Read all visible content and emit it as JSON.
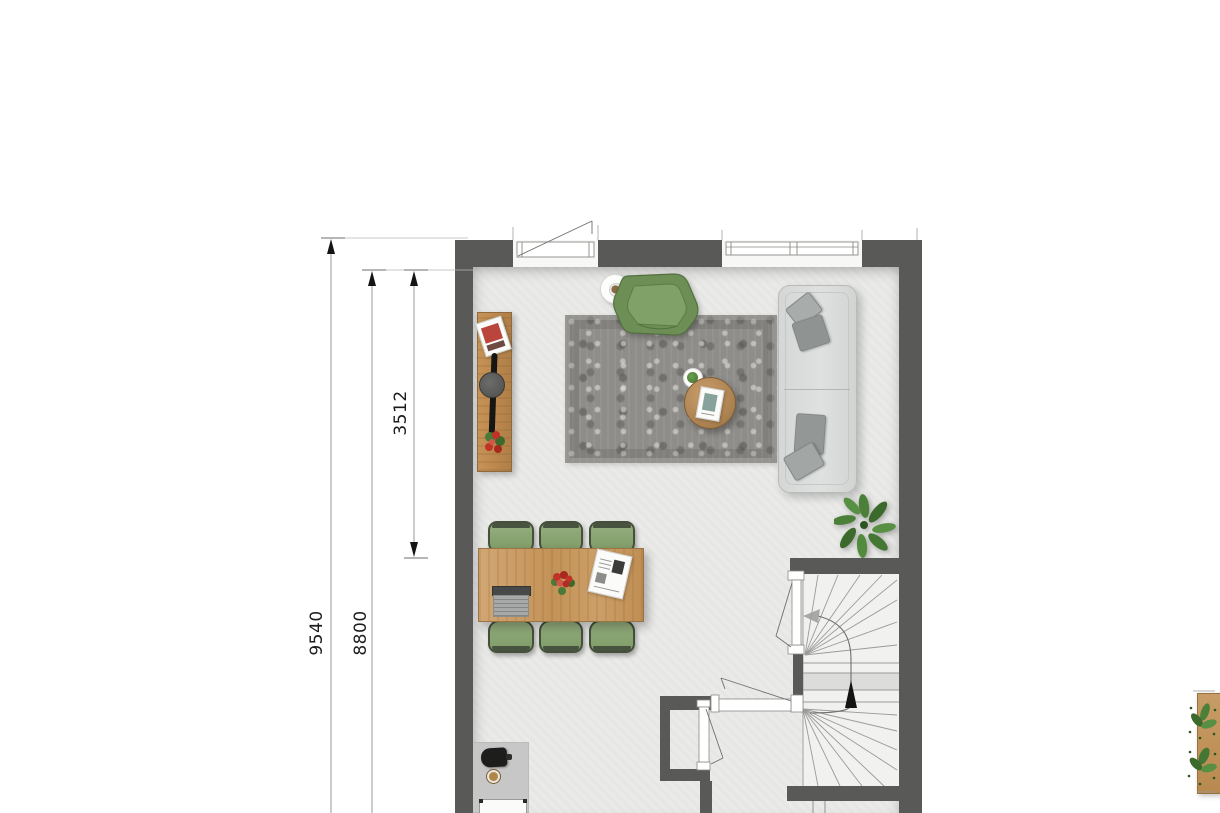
{
  "document": {
    "kind": "architectural floor plan, ground floor with living room, dining area, hall, wc and winder staircase",
    "background": "#ffffff"
  },
  "dimensions": {
    "outer": {
      "value": "9540",
      "orientation": "vertical"
    },
    "inner": {
      "value": "8800",
      "orientation": "vertical"
    },
    "living": {
      "value": "3512",
      "orientation": "vertical"
    }
  },
  "palette": {
    "wall": "#595957",
    "floor": "#eaeae8",
    "stair_floor": "#f1f1ef",
    "stair_landing": "#dcdcda",
    "rug": "#8e8d8a",
    "sofa": "#dcdedd",
    "pillow": "#959998",
    "dining_chair_green": "#84a16c",
    "armchair_green": "#6d8f55",
    "wood": "#c79256",
    "coffee_mat": "#c6c7c6",
    "plant_green": "#487a37",
    "flower_red": "#c13227",
    "dimension_line": "#9a9a98",
    "label_text": "#1c1c1c"
  },
  "furniture": [
    "sideboard with magazine, decor and flowers",
    "green armchair",
    "round side table with coffee cup",
    "vintage grey rug",
    "round wooden coffee table with magazine",
    "small plant on plate",
    "three-seat sofa with cushions",
    "green plant",
    "dining table with six green chairs",
    "laptop",
    "flower bouquet",
    "newspaper",
    "coffee station on mat with stool",
    "winder staircase with up arrow",
    "wall planter with greenery"
  ]
}
